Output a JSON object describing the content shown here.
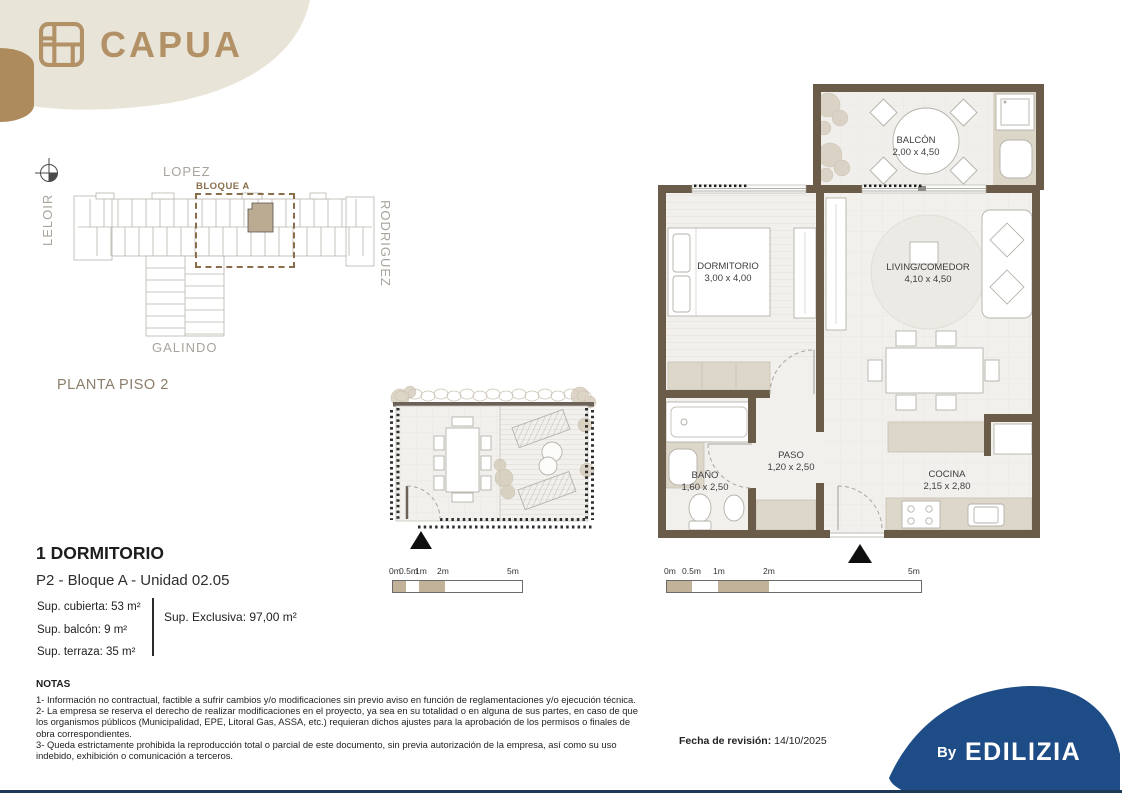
{
  "brand": {
    "logo_text": "CAPUA",
    "by_label": "By",
    "company": "EDILIZIA"
  },
  "site_plan": {
    "streets": {
      "top": "LOPEZ",
      "left": "LELOIR",
      "right": "RODRIGUEZ",
      "bottom": "GALINDO"
    },
    "block_label": "BLOQUE A",
    "floor_label": "PLANTA PISO 2"
  },
  "unit_plan": {
    "rooms": [
      {
        "name": "BALCÓN",
        "dims": "2,00 x 4,50"
      },
      {
        "name": "DORMITORIO",
        "dims": "3,00 x 4,00"
      },
      {
        "name": "LIVING/COMEDOR",
        "dims": "4,10 x 4,50"
      },
      {
        "name": "BAÑO",
        "dims": "1,60 x 2,50"
      },
      {
        "name": "PASO",
        "dims": "1,20 x 2,50"
      },
      {
        "name": "COCINA",
        "dims": "2,15 x 2,80"
      }
    ],
    "scale_labels": [
      "0m",
      "0.5m",
      "1m",
      "2m",
      "5m"
    ]
  },
  "terrace_plan": {
    "scale_labels": [
      "0m",
      "0.5m",
      "1m",
      "2m",
      "5m"
    ]
  },
  "unit_info": {
    "title": "1 DORMITORIO",
    "subtitle": "P2 - Bloque A - Unidad 02.05",
    "areas": [
      "Sup. cubierta: 53 m²",
      "Sup. balcón: 9 m²",
      "Sup. terraza: 35 m²"
    ],
    "exclusive_area": "Sup. Exclusiva: 97,00 m²"
  },
  "notes": {
    "heading": "NOTAS",
    "items": [
      "1- Información no contractual, factible a sufrir cambios y/o modificaciones sin previo aviso en función de reglamentaciones y/o ejecución técnica.",
      "2- La empresa se reserva el derecho de realizar modificaciones en el proyecto, ya sea en su totalidad o en alguna de sus partes, en caso de que los organismos públicos (Municipalidad, EPE, Litoral Gas, ASSA, etc.) requieran dichos ajustes para la aprobación de los permisos o finales de obra correspondientes.",
      "3- Queda estrictamente prohibida la reproducción total o parcial de este documento, sin previa autorización de la empresa, así como su uso indebido, exhibición o comunicación a terceros."
    ]
  },
  "footer": {
    "revision_label": "Fecha de revisión:",
    "revision_date": "14/10/2025"
  },
  "colors": {
    "brand_gold": "#b29166",
    "cream": "#e9e4d8",
    "wall_brown": "#6b5c49",
    "tan_accent": "#c2b29a",
    "counter_beige": "#ddd7ca",
    "brand_blue": "#1e4c86"
  }
}
